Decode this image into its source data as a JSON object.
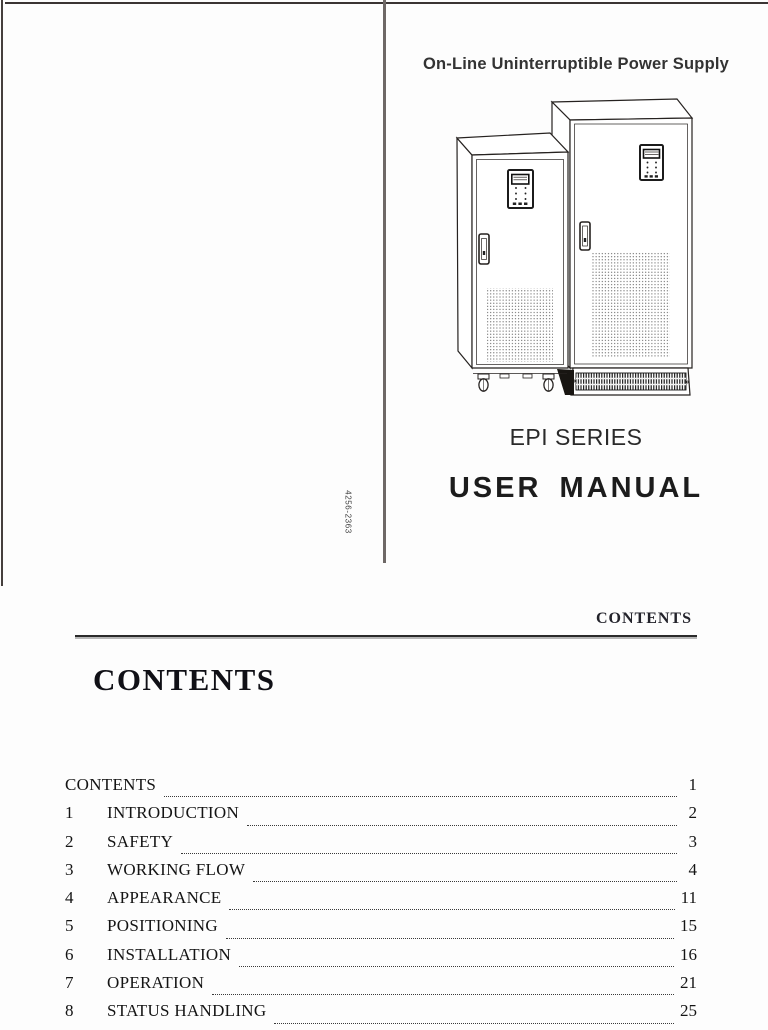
{
  "cover": {
    "product_line": "On-Line Uninterruptible Power Supply",
    "series_name": "EPI SERIES",
    "manual_title": "USER MANUAL",
    "spine_code": "4256-2363",
    "illustration": "two-ups-tower-cabinets-line-art"
  },
  "contents_page": {
    "running_header": "CONTENTS",
    "heading": "CONTENTS",
    "toc_rows": [
      {
        "num": "",
        "title": "CONTENTS",
        "page": "1"
      },
      {
        "num": "1",
        "title": "INTRODUCTION",
        "page": "2"
      },
      {
        "num": "2",
        "title": "SAFETY",
        "page": "3"
      },
      {
        "num": "3",
        "title": "WORKING FLOW",
        "page": "4"
      },
      {
        "num": "4",
        "title": "APPEARANCE",
        "page": "11"
      },
      {
        "num": "5",
        "title": "POSITIONING",
        "page": "15"
      },
      {
        "num": "6",
        "title": "INSTALLATION",
        "page": "16"
      },
      {
        "num": "7",
        "title": "OPERATION",
        "page": "21"
      },
      {
        "num": "8",
        "title": "STATUS HANDLING",
        "page": "25"
      }
    ]
  },
  "colors": {
    "page_background": "#fdfdfd",
    "ink": "#1d1d1d",
    "spine_divider_gray": "#6e6866",
    "page_edge_dark": "#3a3433"
  }
}
